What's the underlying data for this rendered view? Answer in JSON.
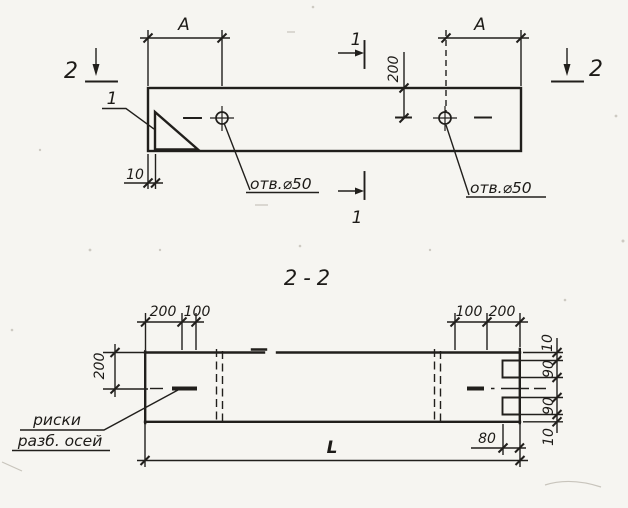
{
  "colors": {
    "ink": "#211f1c",
    "paper": "#f6f5f1"
  },
  "elevation": {
    "dim_a_left": "A",
    "dim_a_right": "A",
    "dim_200": "200",
    "dim_10": "10",
    "detail_mark": "1",
    "section1_top": "1",
    "section1_bottom": "1",
    "section2_left": "2",
    "section2_right": "2",
    "hole_left_label": "отв.⌀50",
    "hole_right_label": "отв.⌀50"
  },
  "section": {
    "title": "2-2",
    "dim_top_left_1": "200",
    "dim_top_left_2": "100",
    "dim_top_right_1": "100",
    "dim_top_right_2": "200",
    "dim_left_200": "200",
    "dim_right": [
      "10",
      "90",
      "90",
      "10"
    ],
    "dim_80": "80",
    "dim_length": "L",
    "axis_label_line1": "риски",
    "axis_label_line2": "разб. осей"
  }
}
